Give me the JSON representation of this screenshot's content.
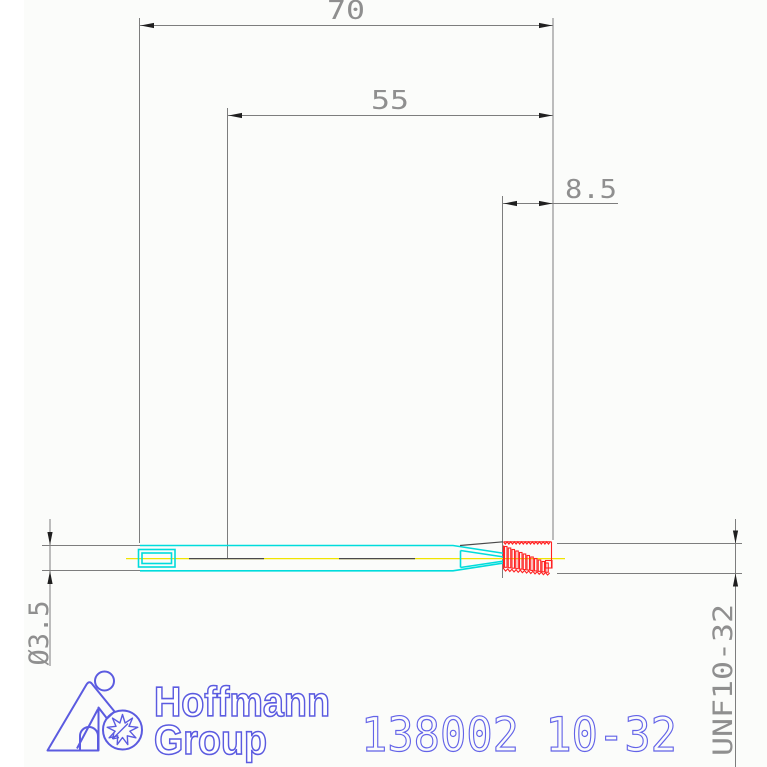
{
  "dimensions": {
    "total_length": "70",
    "shaft_length": "55",
    "thread_length": "8.5",
    "diameter": "Ø3.5",
    "thread_spec": "UNF10-32"
  },
  "part_number": "138002 10-32",
  "logo": {
    "name_line1": "Hoffmann",
    "name_line2": "Group"
  },
  "colors": {
    "body_outline_cyan": "#00dcdc",
    "thread_red": "#ff2222",
    "centerline_yellow": "#f0e400",
    "dimension_line_gray": "#7d7d7d",
    "dimension_text_gray": "#8f8f8f",
    "logo_blue": "#5b5be0",
    "part_number_blue": "#6363e8"
  }
}
